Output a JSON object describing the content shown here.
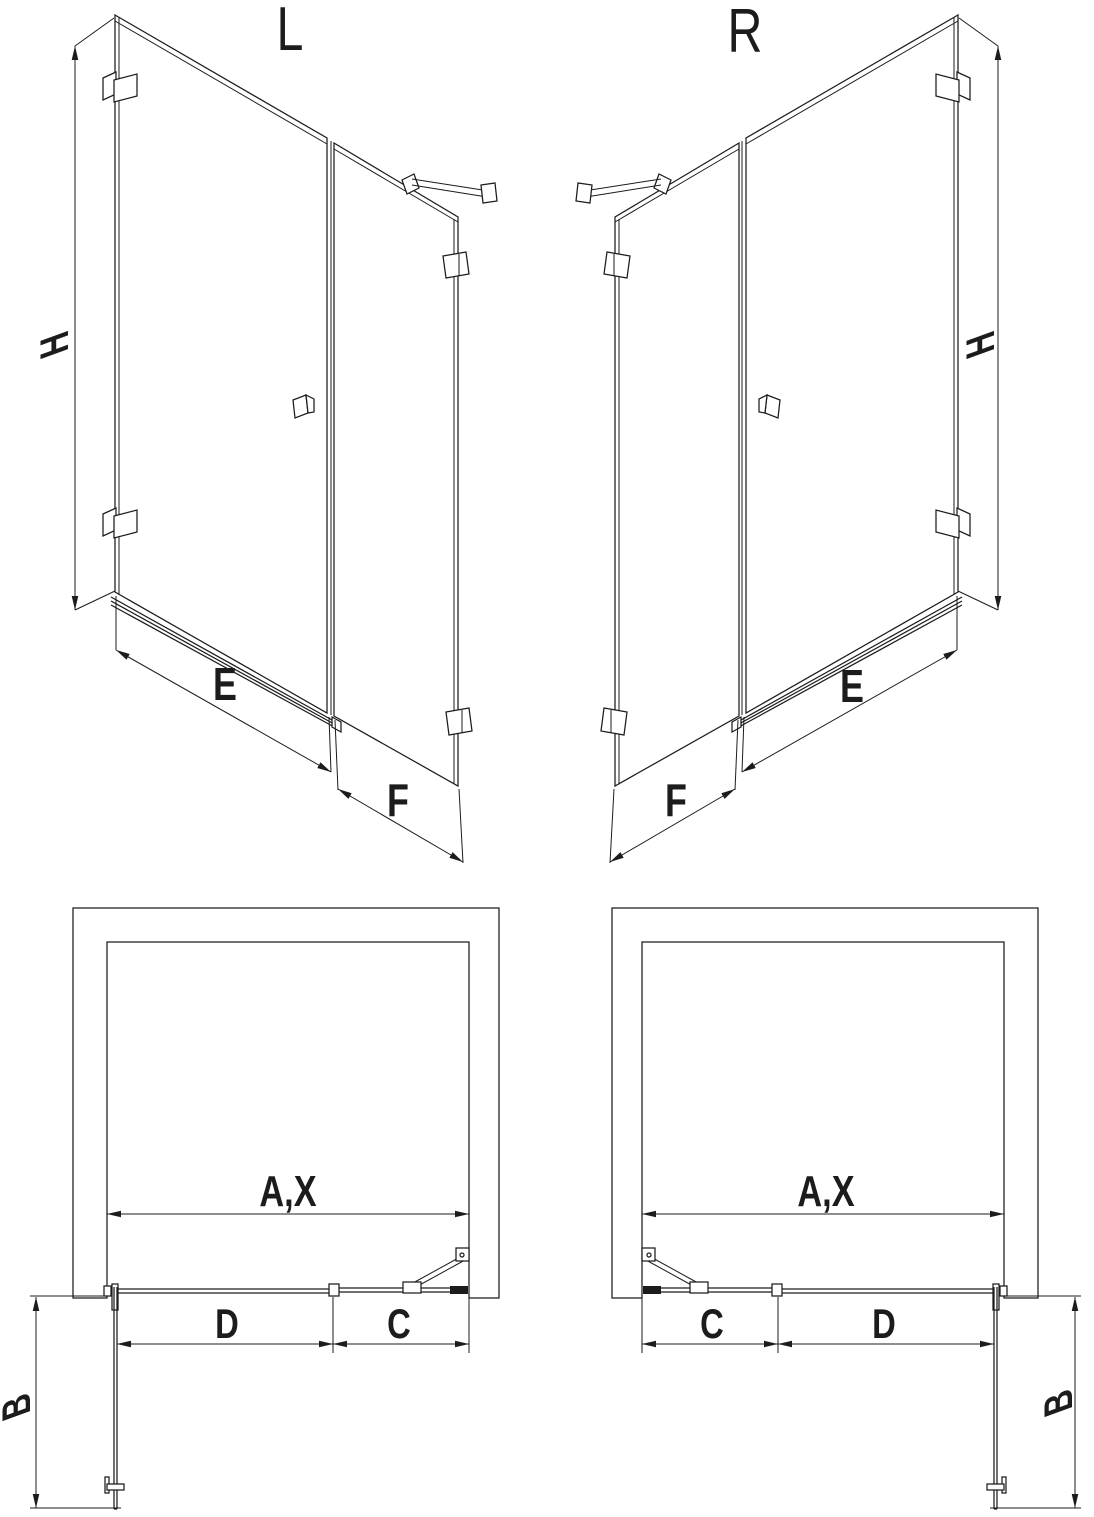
{
  "colors": {
    "line": "#1c1c1c",
    "background": "#ffffff"
  },
  "views": {
    "persp_l": {
      "label": "L",
      "dim_height": "H",
      "dim_door_width": "E",
      "dim_panel_width": "F"
    },
    "persp_r": {
      "label": "R",
      "dim_height": "H",
      "dim_door_width": "E",
      "dim_panel_width": "F"
    },
    "plan_l": {
      "dim_opening": "A,X",
      "dim_door": "D",
      "dim_fixed_panel": "C",
      "dim_return_panel": "B"
    },
    "plan_r": {
      "dim_opening": "A,X",
      "dim_door": "D",
      "dim_fixed_panel": "C",
      "dim_return_panel": "B"
    }
  }
}
